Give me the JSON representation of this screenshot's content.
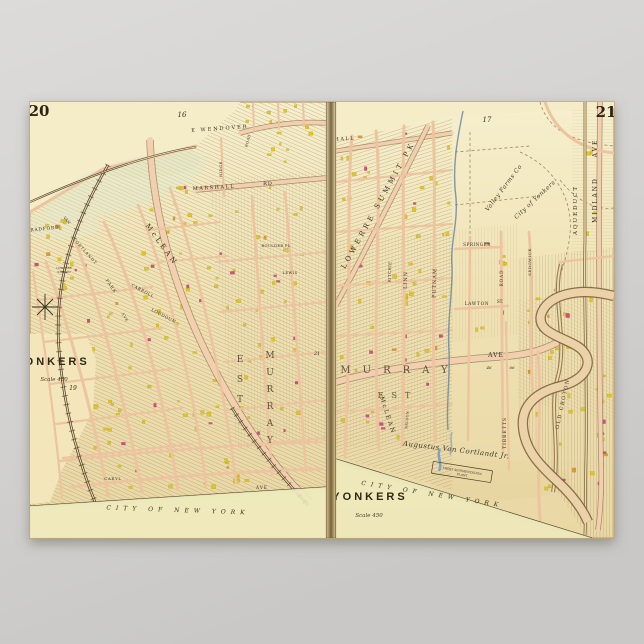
{
  "poster": {
    "kind": "vintage-atlas-map-poster",
    "subject": "Yonkers, New York double atlas plate"
  },
  "palette": {
    "background_top": "#dcdbd9",
    "background_bottom": "#c9c8c6",
    "paper": "#f0e2b4",
    "paper_light": "#f6eecb",
    "road": "#f2cfae",
    "road_casing": "#8d7450",
    "ink": "#3a3020",
    "building_yellow": "#ddc414",
    "building_pink": "#cf3f7c",
    "building_orange": "#dd8f2a",
    "river": "#6b8aa3",
    "creek_blue": "#7fa3c0",
    "boundary_green": "#c9d491",
    "rail": "#4f3d27",
    "gutter": "#55431f"
  },
  "pages": [
    {
      "number": "20",
      "title": "YONKERS",
      "scale_note": "Scale 450",
      "adjacent_plate_refs": [
        "16",
        "19",
        "21"
      ]
    },
    {
      "number": "21",
      "title": "YONKERS",
      "scale_note": "Scale 450",
      "adjacent_plate_refs": [
        "17"
      ]
    }
  ],
  "map_labels": [
    {
      "page": "L",
      "text": "16",
      "x": 182,
      "y": 117,
      "size": 7,
      "cls": "italic"
    },
    {
      "page": "L",
      "text": "E WENDOVER",
      "x": 220,
      "y": 130,
      "size": 5,
      "rot": -4,
      "ls": 2
    },
    {
      "page": "L",
      "text": "ROAD",
      "x": 249,
      "y": 141,
      "size": 3.6,
      "rot": -74,
      "ls": 0.5
    },
    {
      "page": "L",
      "text": "RIDGE",
      "x": 222,
      "y": 169,
      "size": 3.8,
      "rot": -90,
      "ls": 0.5
    },
    {
      "page": "L",
      "text": "MARSHALL",
      "x": 214,
      "y": 189,
      "size": 5,
      "rot": -3,
      "ls": 1.5
    },
    {
      "page": "L",
      "text": "RD",
      "x": 268,
      "y": 185,
      "size": 5,
      "ls": 1
    },
    {
      "page": "L",
      "text": "RADFORD",
      "x": 45,
      "y": 230,
      "size": 4.4,
      "rot": -6,
      "ls": 0.8
    },
    {
      "page": "L",
      "text": "VAN",
      "x": 66,
      "y": 221,
      "size": 3.8,
      "rot": 48
    },
    {
      "page": "L",
      "text": "CORTLANDT",
      "x": 84,
      "y": 252,
      "size": 4,
      "rot": 48,
      "ls": 0.8
    },
    {
      "page": "L",
      "text": "PARK",
      "x": 110,
      "y": 287,
      "size": 4.4,
      "rot": 55,
      "ls": 1
    },
    {
      "page": "L",
      "text": "AVE",
      "x": 124,
      "y": 318,
      "size": 3.6,
      "rot": 60,
      "ls": 0.8
    },
    {
      "page": "L",
      "text": "LOWERRE",
      "x": 64,
      "y": 269,
      "size": 2.8
    },
    {
      "page": "L",
      "text": "STATION",
      "x": 64,
      "y": 273,
      "size": 2.8
    },
    {
      "page": "L",
      "text": "McLEAN",
      "x": 160,
      "y": 246,
      "size": 7,
      "rot": 54,
      "ls": 3
    },
    {
      "page": "L",
      "text": "CARROLL",
      "x": 142,
      "y": 292,
      "size": 4.2,
      "rot": 28,
      "ls": 0.5
    },
    {
      "page": "L",
      "text": "LOUDOUN",
      "x": 163,
      "y": 317,
      "size": 4.2,
      "rot": 28,
      "ls": 0.5
    },
    {
      "page": "L",
      "text": "BOULDER PL",
      "x": 276,
      "y": 247,
      "size": 3.6,
      "ls": 0.4
    },
    {
      "page": "L",
      "text": "LEWIS",
      "x": 290,
      "y": 274,
      "size": 3.6,
      "ls": 0.5
    },
    {
      "page": "L",
      "text": "EST",
      "x": 240,
      "y": 362,
      "size": 9,
      "vstack": true,
      "step": 20,
      "cls": "caps-lg"
    },
    {
      "page": "L",
      "text": "MURRAY",
      "x": 270,
      "y": 358,
      "size": 9,
      "vstack": true,
      "step": 17,
      "cls": "caps-lg"
    },
    {
      "page": "L",
      "text": "21",
      "x": 317,
      "y": 355,
      "size": 5,
      "cls": "italic"
    },
    {
      "page": "L",
      "text": "YONKERS",
      "x": 52,
      "y": 365,
      "size": 11,
      "ls": 3,
      "cls": "bold-caps"
    },
    {
      "page": "L",
      "text": "Scale 450",
      "x": 54,
      "y": 381,
      "size": 5.5,
      "cls": "script"
    },
    {
      "page": "L",
      "text": "19",
      "x": 73,
      "y": 390,
      "size": 6,
      "cls": "italic"
    },
    {
      "page": "L",
      "text": "CARYL",
      "x": 113,
      "y": 480,
      "size": 3.8,
      "ls": 0.8
    },
    {
      "page": "L",
      "text": "AVE",
      "x": 262,
      "y": 489,
      "size": 4.2,
      "ls": 1
    },
    {
      "page": "L",
      "text": "CITY OF NEW YORK",
      "x": 178,
      "y": 512,
      "size": 6,
      "rot": 2,
      "ls": 5,
      "cls": "boundary"
    },
    {
      "page": "R",
      "text": "17",
      "x": 487,
      "y": 122,
      "size": 7,
      "cls": "italic"
    },
    {
      "page": "R",
      "text": "MARSHALL",
      "x": 334,
      "y": 141,
      "size": 5,
      "rot": -4,
      "ls": 1.5
    },
    {
      "page": "R",
      "text": "LOWERRE SUMMIT PK",
      "x": 380,
      "y": 206,
      "size": 7,
      "rot": -61,
      "ls": 3.5
    },
    {
      "page": "R",
      "text": "RITCHIE",
      "x": 391,
      "y": 272,
      "size": 3.8,
      "rot": -88,
      "ls": 0.5
    },
    {
      "page": "R",
      "text": "LINN",
      "x": 407,
      "y": 280,
      "size": 5,
      "rot": -88,
      "ls": 1
    },
    {
      "page": "R",
      "text": "PUTNAM",
      "x": 436,
      "y": 283,
      "size": 5,
      "rot": -88,
      "ls": 1
    },
    {
      "page": "R",
      "text": "SPRINGER",
      "x": 477,
      "y": 246,
      "size": 4.2,
      "ls": 0.5
    },
    {
      "page": "R",
      "text": "ROAD",
      "x": 503,
      "y": 278,
      "size": 4.2,
      "rot": -90,
      "ls": 1
    },
    {
      "page": "R",
      "text": "SEDGWICK",
      "x": 531,
      "y": 262,
      "size": 4,
      "rot": -90,
      "ls": 0.5
    },
    {
      "page": "R",
      "text": "LAWTON",
      "x": 477,
      "y": 305,
      "size": 4.2,
      "ls": 0.8
    },
    {
      "page": "R",
      "text": "ST.",
      "x": 500,
      "y": 303,
      "size": 4.2
    },
    {
      "page": "R",
      "text": "Valley Farms Co",
      "x": 505,
      "y": 189,
      "size": 6,
      "rot": -53,
      "ls": 0.5,
      "cls": "script"
    },
    {
      "page": "R",
      "text": "City of Yonkers",
      "x": 536,
      "y": 201,
      "size": 6,
      "rot": -43,
      "ls": 0.5,
      "cls": "script"
    },
    {
      "page": "R",
      "text": "AQUEDUCT",
      "x": 577,
      "y": 210,
      "size": 5.5,
      "rot": -90,
      "ls": 2
    },
    {
      "page": "R",
      "text": "MIDLAND",
      "x": 597,
      "y": 200,
      "size": 6,
      "rot": -90,
      "ls": 2
    },
    {
      "page": "R",
      "text": "AVE",
      "x": 597,
      "y": 148,
      "size": 6,
      "rot": -90,
      "ls": 2
    },
    {
      "page": "R",
      "text": "MURRAY",
      "x": 400,
      "y": 373,
      "size": 10,
      "ls": 12,
      "cls": "caps-lg"
    },
    {
      "page": "R",
      "text": "AVE",
      "x": 496,
      "y": 357,
      "size": 6,
      "ls": 1
    },
    {
      "page": "R",
      "text": "46",
      "x": 489,
      "y": 369,
      "size": 4,
      "cls": "italic"
    },
    {
      "page": "R",
      "text": "66",
      "x": 512,
      "y": 369,
      "size": 4,
      "cls": "italic"
    },
    {
      "page": "R",
      "text": "EST",
      "x": 398,
      "y": 398,
      "size": 8,
      "ls": 8,
      "cls": "caps-lg"
    },
    {
      "page": "R",
      "text": "McLEAN",
      "x": 386,
      "y": 416,
      "size": 6,
      "rot": 72,
      "ls": 2
    },
    {
      "page": "R",
      "text": "NELSON",
      "x": 408,
      "y": 420,
      "size": 3.4,
      "rot": -85,
      "ls": 0.4
    },
    {
      "page": "R",
      "text": "TIBBETTS",
      "x": 506,
      "y": 433,
      "size": 4.5,
      "rot": -90,
      "ls": 1
    },
    {
      "page": "R",
      "text": "OLD CROTON",
      "x": 564,
      "y": 404,
      "size": 5,
      "rot": -78,
      "ls": 1.5
    },
    {
      "page": "R",
      "text": "Augustus Van Cortlandt Jr.",
      "x": 456,
      "y": 452,
      "size": 7,
      "rot": 7,
      "ls": 0.5,
      "cls": "script"
    },
    {
      "page": "R",
      "text": "FROST SEDIMENTATION",
      "x": 462,
      "y": 472,
      "size": 3,
      "rot": 9
    },
    {
      "page": "R",
      "text": "PLANT",
      "x": 462,
      "y": 476,
      "size": 3,
      "rot": 9
    },
    {
      "page": "R",
      "text": "YONKERS",
      "x": 370,
      "y": 500,
      "size": 11,
      "ls": 3,
      "cls": "bold-caps"
    },
    {
      "page": "R",
      "text": "Scale 450",
      "x": 369,
      "y": 517,
      "size": 5.5,
      "cls": "script"
    },
    {
      "page": "R",
      "text": "CITY OF NEW YORK",
      "x": 432,
      "y": 496,
      "size": 6,
      "rot": 9,
      "ls": 5,
      "cls": "boundary"
    }
  ]
}
